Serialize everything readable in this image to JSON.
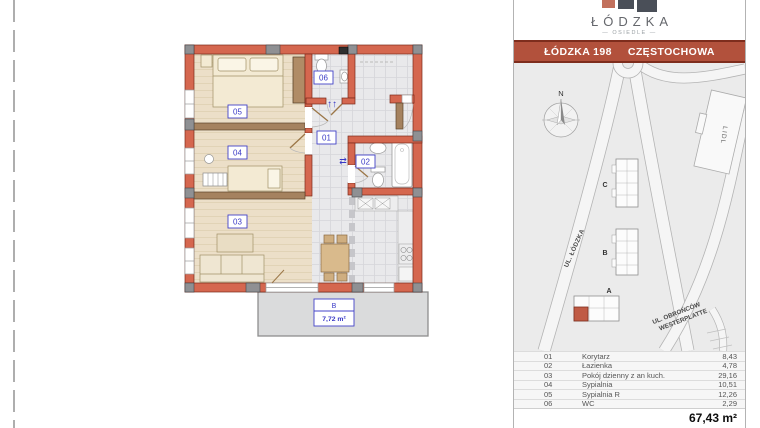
{
  "plan": {
    "room_labels": [
      {
        "id": "room-05",
        "text": "05"
      },
      {
        "id": "room-04",
        "text": "04"
      },
      {
        "id": "room-03",
        "text": "03"
      },
      {
        "id": "room-01",
        "text": "01"
      },
      {
        "id": "room-02",
        "text": "02"
      },
      {
        "id": "room-06",
        "text": "06"
      }
    ],
    "balcony": {
      "code": "B",
      "area": "7,72 m²"
    },
    "entry_arrows": "↑↑",
    "door_arrows": "⇄"
  },
  "sidebar": {
    "logo": {
      "title": "ŁÓDZKA",
      "subtitle": "— OSIEDLE —"
    },
    "banner": {
      "project": "ŁÓDZKA 198",
      "city": "CZĘSTOCHOWA"
    },
    "map": {
      "compass_label": "N",
      "street_lodzka": "UL. ŁÓDZKA",
      "street_obroncow_line1": "UL. OBROŃCÓW",
      "street_obroncow_line2": "WESTERPLATTE",
      "store_label": "LIDL",
      "building_a": "A",
      "building_b": "B",
      "building_c": "C"
    },
    "rooms_table": {
      "rows": [
        {
          "no": "01",
          "name": "Korytarz",
          "area": "8,43"
        },
        {
          "no": "02",
          "name": "Łazienka",
          "area": "4,78"
        },
        {
          "no": "03",
          "name": "Pokój dzienny z an kuch.",
          "area": "29,16"
        },
        {
          "no": "04",
          "name": "Sypialnia",
          "area": "10,51"
        },
        {
          "no": "05",
          "name": "Sypialnia R",
          "area": "12,26"
        },
        {
          "no": "06",
          "name": "WC",
          "area": "2,29"
        }
      ],
      "total": "67,43 m²"
    }
  },
  "colors": {
    "accent_red": "#b2513c",
    "wall_salmon": "#d5674f",
    "partition_brown": "#a5825f",
    "unit_highlight": "#c05b45",
    "label_blue": "#3a3ac6"
  }
}
